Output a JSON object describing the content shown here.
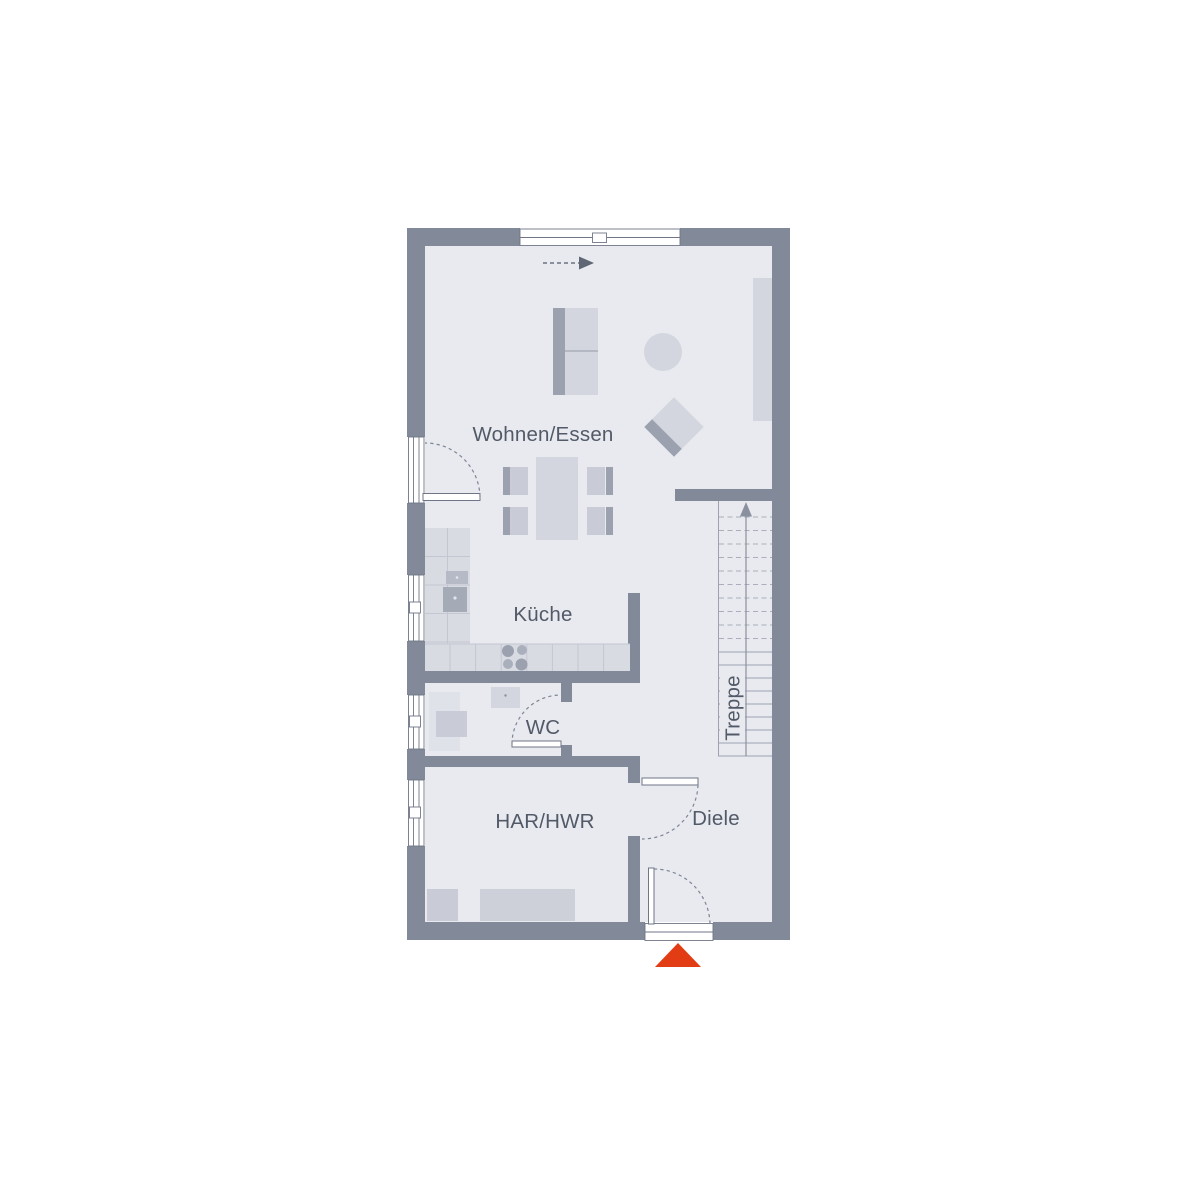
{
  "plan": {
    "type": "floor-plan",
    "rooms": [
      {
        "id": "wohnen-essen",
        "label": "Wohnen/Essen"
      },
      {
        "id": "kueche",
        "label": "Küche"
      },
      {
        "id": "wc",
        "label": "WC"
      },
      {
        "id": "har-hwr",
        "label": "HAR/HWR"
      },
      {
        "id": "diele",
        "label": "Diele"
      },
      {
        "id": "treppe",
        "label": "Treppe"
      }
    ],
    "stairs": {
      "label": "Treppe",
      "dashed_treads": 10,
      "solid_treads": 9,
      "direction_arrow": "up"
    },
    "entrance": {
      "marker": "red-triangle",
      "position": "bottom-wall"
    },
    "sliding_door_arrow_direction": "right",
    "colors": {
      "wall": "#828a99",
      "floor": "#e8eaf0",
      "furniture_light": "#d3d6de",
      "furniture_mid": "#c9ccd6",
      "furniture_dark": "#9ba1ae",
      "cabinet": "#d9dbe3",
      "label_text": "#525a68",
      "entrance_marker": "#e23c15",
      "background": "#ffffff"
    }
  }
}
